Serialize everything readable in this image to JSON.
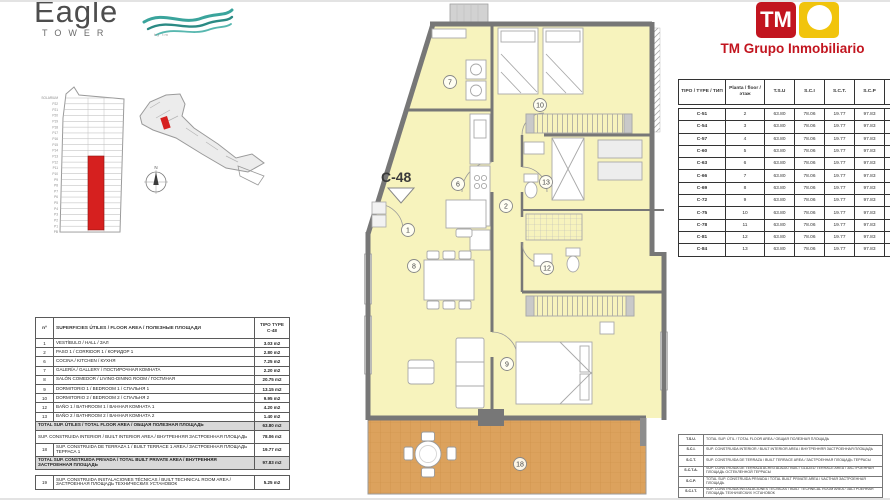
{
  "branding": {
    "eagle": {
      "word": "Eagle",
      "sub": "TOWER",
      "tagline": "by tm",
      "wave_color": "#3aa49c"
    },
    "tm": {
      "monogram": "TM",
      "company": "TM Grupo Inmobiliario",
      "red": "#c2151f",
      "yellow": "#f1c40c"
    }
  },
  "plan": {
    "label": "C-48",
    "rooms": {
      "hall": "1",
      "corridor": "2",
      "kitchen": "6",
      "gallery": "7",
      "living": "8",
      "bedroom1": "9",
      "bedroom2": "10",
      "bath1": "12",
      "bath2": "13",
      "terrace": "18"
    }
  },
  "tower": {
    "floors": [
      "SOLARIUM",
      "P22",
      "P21",
      "P20",
      "P19",
      "P18",
      "P17",
      "P16",
      "P15",
      "P14",
      "P13",
      "P12",
      "P11",
      "P10",
      "P9",
      "P8",
      "P7",
      "P6",
      "P5",
      "P4",
      "P3",
      "P2",
      "P1",
      "PB"
    ],
    "highlight_color": "#d6201f"
  },
  "site_map": {
    "compass_label": "N",
    "marker_color": "#d6201f"
  },
  "areas_table": {
    "header": {
      "num": "nº",
      "desc": "SUPERFICIES ÚTILES / FLOOR AREA / ПОЛЕЗНЫЕ ПЛОЩАДИ",
      "type_label": "TIPO TYPE",
      "type_value": "C-48"
    },
    "rows": [
      {
        "num": "1",
        "desc": "VESTÍBULO / HALL / ЗАЛ",
        "value": "3.03 m2"
      },
      {
        "num": "2",
        "desc": "PASO 1 / CORRIDOR 1 / КОРИДОР 1",
        "value": "2.80 m2"
      },
      {
        "num": "6",
        "desc": "COCINA / KITCHEN / КУХНЯ",
        "value": "7.25 m2"
      },
      {
        "num": "7",
        "desc": "GALERÍA / GALLERY / ПОСТИРОЧНАЯ КОМНАТА",
        "value": "2.20 m2"
      },
      {
        "num": "8",
        "desc": "SALÓN COMEDOR / LIVING-DINING ROOM / ГОСТИНАЯ",
        "value": "20.75 m2"
      },
      {
        "num": "9",
        "desc": "DORMITORIO 1 / BEDROOM 1 / СПАЛЬНЯ 1",
        "value": "13.15 m2"
      },
      {
        "num": "10",
        "desc": "DORMITORIO 2 / BEDROOM 2 / СПАЛЬНЯ 2",
        "value": "9.95 m2"
      },
      {
        "num": "12",
        "desc": "BAÑO 1 / BATHROOM 1 / ВАННАЯ КОМНАТА 1",
        "value": "4.20 m2"
      },
      {
        "num": "13",
        "desc": "BAÑO 2 / BATHROOM 2 / ВАННАЯ КОМНАТА 2",
        "value": "1.40 m2"
      },
      {
        "num": null,
        "desc": "TOTAL SUP. ÚTILES / TOTAL FLOOR AREA / ОБЩАЯ ПОЛЕЗНАЯ ПЛОЩАДЬ",
        "value": "63.80 m2",
        "shaded": true
      },
      {
        "num": null,
        "desc": "SUP. CONSTRUIDA INTERIOR / BUILT INTERIOR AREA / ВНУТРЕННЯЯ ЗАСТРОЕННАЯ ПЛОЩАДЬ",
        "value": "78.06 m2",
        "tall": true
      },
      {
        "num": "18",
        "desc": "SUP. CONSTRUIDA DE TERRAZA 1 / BUILT TERRACE 1 AREA / ЗАСТРОЕННАЯ ПЛОЩАДЬ ТЕРРАСА 1",
        "value": "19.77 m2",
        "tall": true
      },
      {
        "num": null,
        "desc": "TOTAL SUP. CONSTRUIDA PRIVADA / TOTAL BUILT PRIVATE AREA / ВНУТРЕННЯЯ ЗАСТРОЕННАЯ ПЛОЩАДЬ",
        "value": "97.83 m2",
        "shaded": true,
        "tall": true
      }
    ],
    "extra_rows": [
      {
        "num": "19",
        "desc": "SUP. CONSTRUIDA INSTALACIONES TÉCNICAS / BUILT TECHNICAL ROOM AREA / ЗАСТРОЕННАЯ ПЛОЩАДЬ ТЕХНИЧЕСКИХ УСТАНОВОК",
        "value": "5.25 m2"
      }
    ]
  },
  "types_table": {
    "headers": [
      "TIPO / TYPE / ТИП",
      "Planta / floor / этаж",
      "T.S.U",
      "S.C.I",
      "S.C.T.",
      "S.C.P",
      "S.C.I.T"
    ],
    "rows": [
      [
        "C-51",
        "2",
        "63.80",
        "78.06",
        "19.77",
        "97.83",
        "5.25"
      ],
      [
        "C-54",
        "3",
        "63.80",
        "78.06",
        "19.77",
        "97.83",
        "5.25"
      ],
      [
        "C-57",
        "4",
        "63.80",
        "78.06",
        "19.77",
        "97.83",
        "5.25"
      ],
      [
        "C-60",
        "5",
        "63.80",
        "78.06",
        "19.77",
        "97.83",
        "5.25"
      ],
      [
        "C-63",
        "6",
        "63.80",
        "78.06",
        "19.77",
        "97.83",
        "5.25"
      ],
      [
        "C-66",
        "7",
        "63.80",
        "78.06",
        "19.77",
        "97.83",
        "5.25"
      ],
      [
        "C-69",
        "8",
        "63.80",
        "78.06",
        "19.77",
        "97.83",
        "5.25"
      ],
      [
        "C-72",
        "9",
        "63.80",
        "78.06",
        "19.77",
        "97.83",
        "5.25"
      ],
      [
        "C-75",
        "10",
        "63.80",
        "78.06",
        "19.77",
        "97.83",
        "5.25"
      ],
      [
        "C-78",
        "11",
        "63.80",
        "78.06",
        "19.77",
        "97.83",
        "5.25"
      ],
      [
        "C-81",
        "12",
        "63.80",
        "78.06",
        "19.77",
        "97.83",
        "5.25"
      ],
      [
        "C-84",
        "13",
        "63.80",
        "78.06",
        "19.77",
        "97.83",
        "5.25"
      ]
    ]
  },
  "legend_table": {
    "rows": [
      [
        "T.S.U.",
        "TOTAL SUP. ÚTIL / TOTAL FLOOR AREA / ОБЩАЯ ПОЛЕЗНАЯ ПЛОЩАДЬ"
      ],
      [
        "S.C.I.",
        "SUP. CONSTRUIDA INTERIOR / BUILT INTERIOR AREA / ВНУТРЕННЯЯ ЗАСТРОЕННАЯ ПЛОЩАДЬ"
      ],
      [
        "S.C.T.",
        "SUP. CONSTRUIDA DE TERRAZA / BUILT TERRACE AREA / ЗАСТРОЕННАЯ ПЛОЩАДЬ ТЕРРАСЫ"
      ],
      [
        "S.C.T.A.",
        "SUP. CONSTRUIDA DE TERRAZA ACRISTALADA / BUILT GLAZED TERRACE AREA / ЗАСТРОЕННАЯ ПЛОЩАДЬ ОСТЕКЛЕННОЙ ТЕРРАСЫ"
      ],
      [
        "S.C.P.",
        "TOTAL SUP. CONSTRUIDA PRIVADA / TOTAL BUILT PRIVATE AREA / ЧАСТНАЯ ЗАСТРОЕННАЯ ПЛОЩАДЬ"
      ],
      [
        "S.C.I.T.",
        "SUP. CONSTRUIDA INSTALACIONES TÉCNICAS / BUILT TECHNICAL ROOM AREA / ЗАСТРОЕННАЯ ПЛОЩАДЬ ТЕХНИЧЕСКИХ УСТАНОВОК"
      ]
    ]
  }
}
